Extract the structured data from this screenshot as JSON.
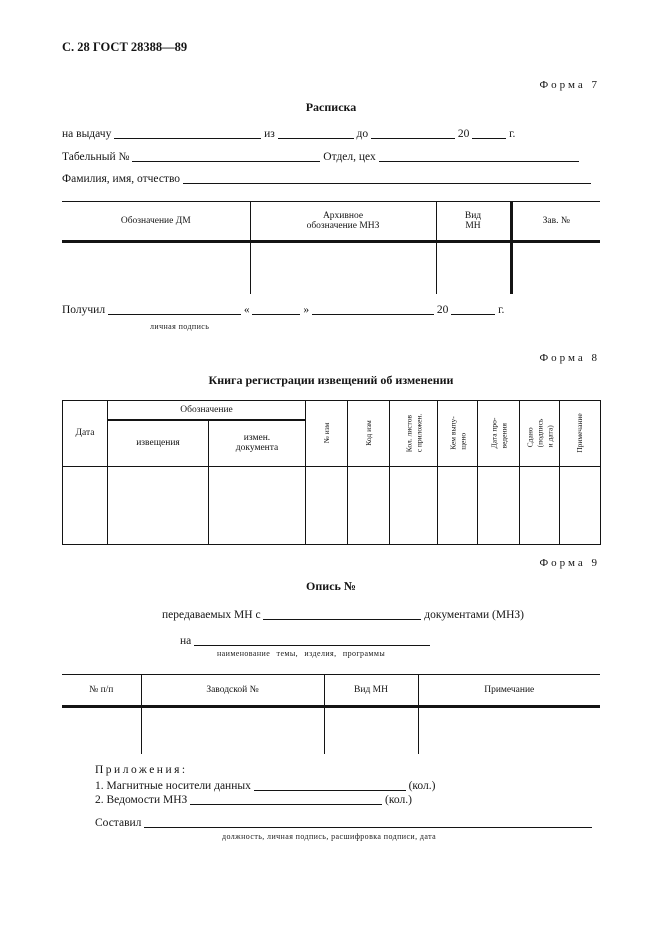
{
  "page_header": "С. 28 ГОСТ 28388—89",
  "form7": {
    "label": "Форма 7",
    "title": "Расписка",
    "issue_line": {
      "l1": "на выдачу",
      "l2": "из",
      "l3": "до",
      "l4": "20",
      "l5": "г."
    },
    "personnel_line": {
      "l1": "Табельный №",
      "l2": "Отдел, цех"
    },
    "name_line": {
      "l1": "Фамилия, имя, отчество"
    },
    "table": {
      "col_dm": "Обозначение ДМ",
      "col_archive": "Архивное\nобозначение МНЗ",
      "col_kind": "Вид\nМН",
      "col_serial": "Зав. №"
    },
    "received_line": {
      "l1": "Получил",
      "q1": "«",
      "q2": "»",
      "l2": "20",
      "l3": "г."
    },
    "signature_caption": "личная подпись"
  },
  "form8": {
    "label": "Форма 8",
    "title": "Книга регистрации извещений об изменении",
    "table": {
      "col_date": "Дата",
      "col_designation": "Обозначение",
      "col_notice": "извещения",
      "col_changed_doc": "измен.\nдокумента",
      "col_change_no": "№ изм",
      "col_change_code": "Код изм",
      "col_sheet_count": "Кол. листов\nс приложен.",
      "col_issued_by": "Кем выпу-\nщено",
      "col_date_done": "Дата про-\nведения",
      "col_handed_over": "Сдано\n(подпись\nи дата)",
      "col_note": "Примечание"
    }
  },
  "form9": {
    "label": "Форма 9",
    "title": "Опись №",
    "transfer_line": {
      "l1": "передаваемых МН с",
      "l2": "документами (МНЗ)"
    },
    "subject_line": {
      "l1": "на"
    },
    "subject_caption": "наименование темы, изделия, программы",
    "table": {
      "col_no": "№ п/п",
      "col_factory_no": "Заводской №",
      "col_kind": "Вид МН",
      "col_note": "Примечание"
    },
    "attachments": {
      "title": "Приложения:",
      "item1_no": "1.",
      "item1_text": "Магнитные носители данных",
      "item1_qty": "(кол.)",
      "item2_no": "2.",
      "item2_text": "Ведомости МНЗ",
      "item2_qty": "(кол.)"
    },
    "composed_line": {
      "l1": "Составил"
    },
    "composed_caption": "должность, личная подпись, расшифровка подписи, дата"
  }
}
